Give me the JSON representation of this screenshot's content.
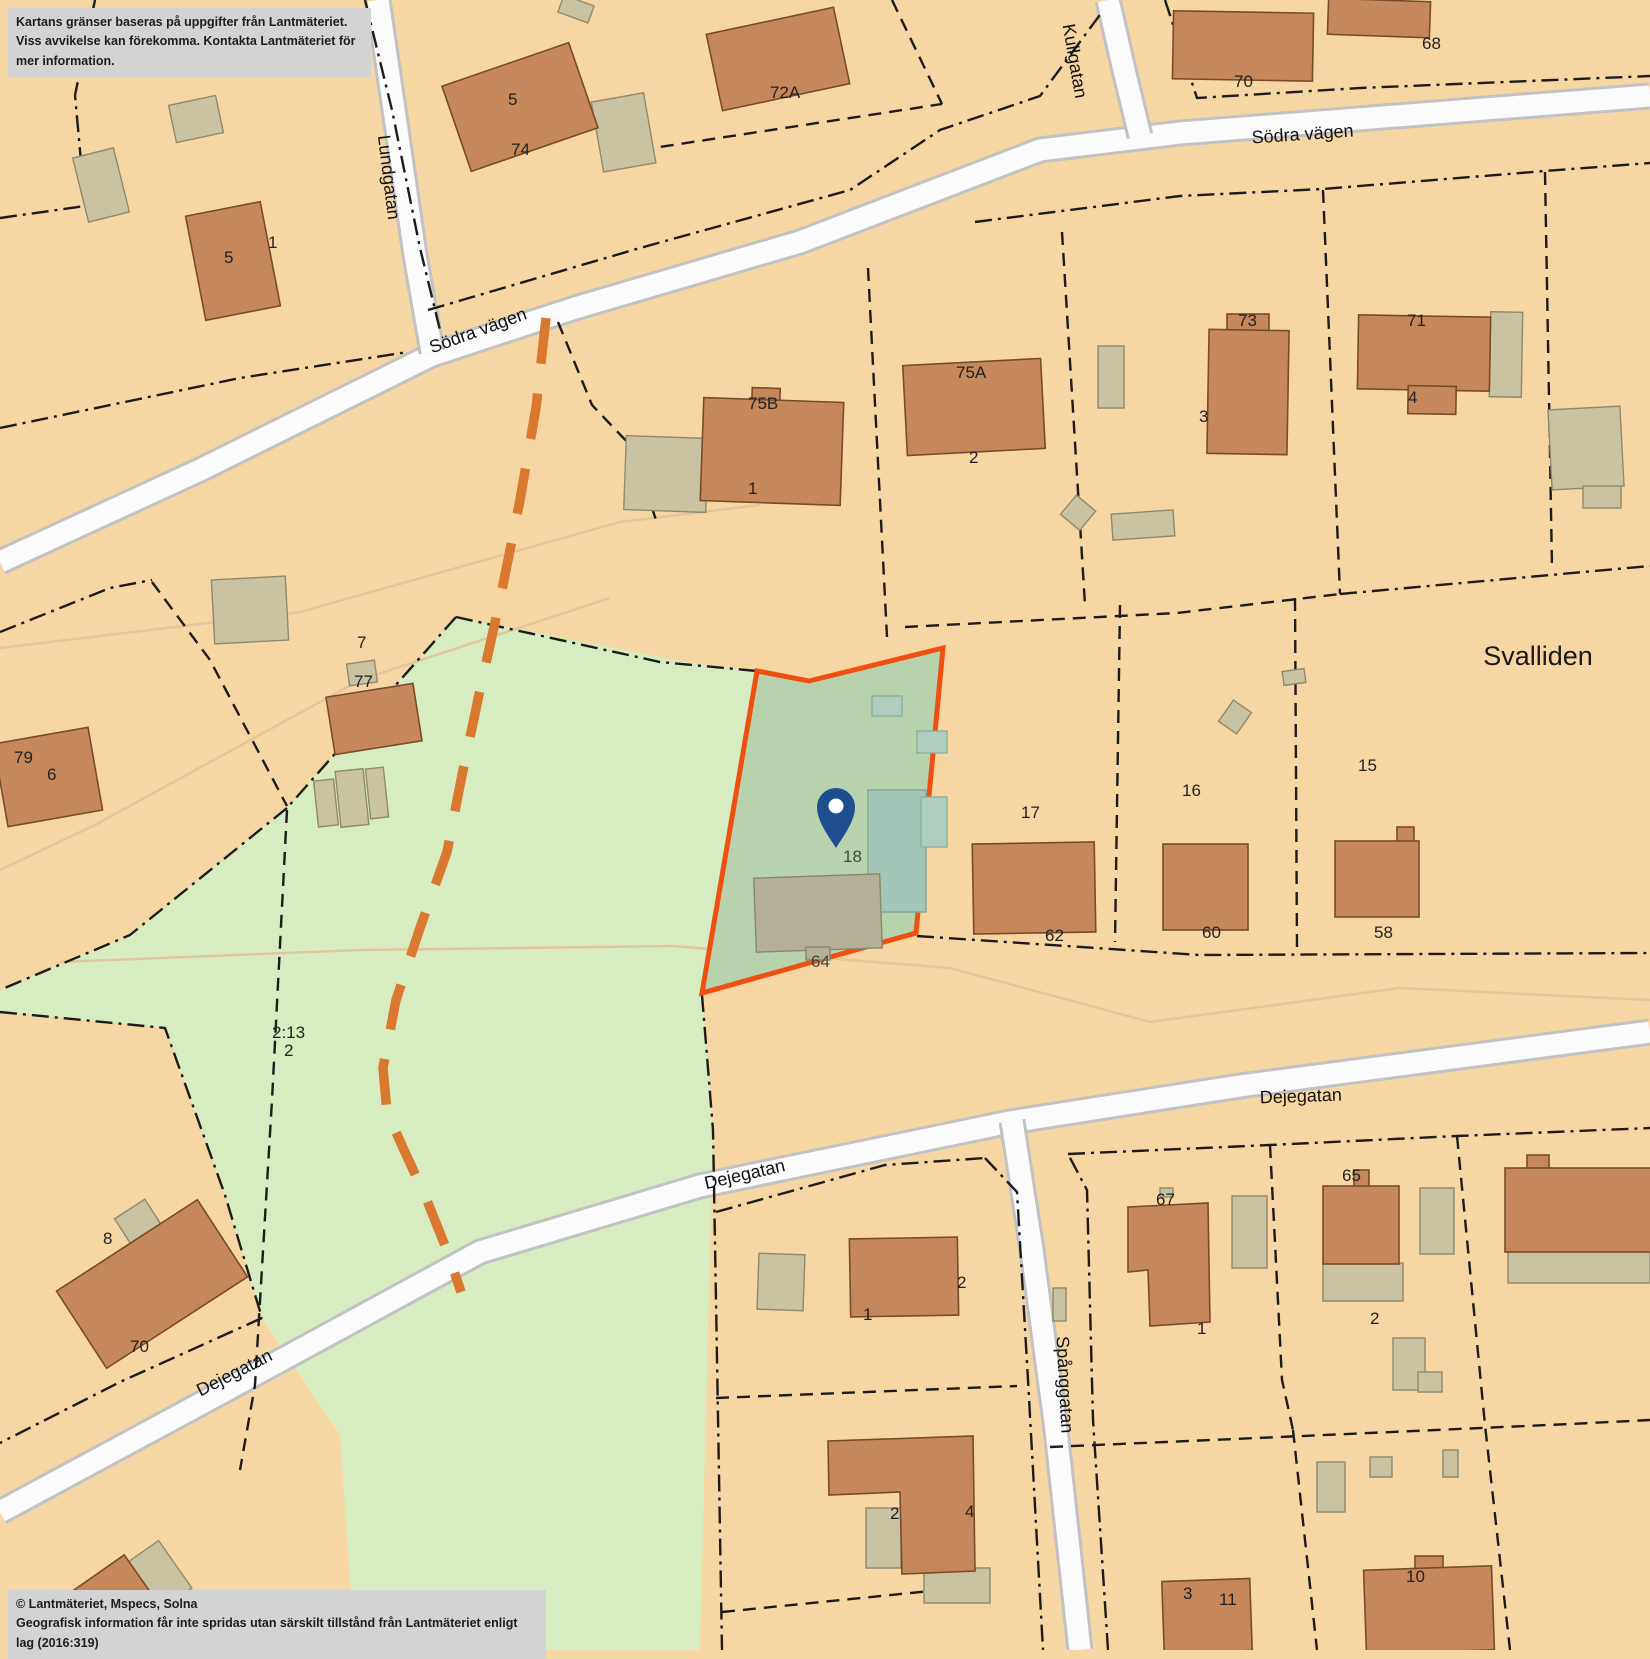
{
  "notices": {
    "disclaimer_line1": "Kartans gränser baseras på uppgifter från Lantmäteriet.",
    "disclaimer_line2": "Viss avvikelse kan förekomma. Kontakta Lantmäteriet för mer information.",
    "copyright_line1": "© Lantmäteriet, Mspecs, Solna",
    "copyright_line2": "Geografisk information får inte spridas utan särskilt tillstånd från Lantmäteriet enligt lag (2016:319)"
  },
  "streets": {
    "lundgatan": "Lundgatan",
    "kullgatan": "Kullgatan",
    "sodra_vagen": "Södra vägen",
    "dejegatan": "Dejegatan",
    "spanggatan": "Spånggatan"
  },
  "area": {
    "name": "Svalliden"
  },
  "marker": {
    "label": "18",
    "icon": "location-pin-icon",
    "color": "#1d4e8f"
  },
  "highlight": {
    "house_label": "64",
    "border_color": "#f04f12",
    "fill_color": "#b7d2ac"
  },
  "labels": [
    {
      "t": "5"
    },
    {
      "t": "1"
    },
    {
      "t": "5"
    },
    {
      "t": "74"
    },
    {
      "t": "72A"
    },
    {
      "t": "68"
    },
    {
      "t": "70"
    },
    {
      "t": "75B"
    },
    {
      "t": "1"
    },
    {
      "t": "75A"
    },
    {
      "t": "2"
    },
    {
      "t": "73"
    },
    {
      "t": "3"
    },
    {
      "t": "71"
    },
    {
      "t": "4"
    },
    {
      "t": "7"
    },
    {
      "t": "77"
    },
    {
      "t": "79"
    },
    {
      "t": "6"
    },
    {
      "t": "15"
    },
    {
      "t": "58"
    },
    {
      "t": "16"
    },
    {
      "t": "60"
    },
    {
      "t": "17"
    },
    {
      "t": "62"
    },
    {
      "t": "18"
    },
    {
      "t": "64"
    },
    {
      "t": "2:13"
    },
    {
      "t": "2"
    },
    {
      "t": "8"
    },
    {
      "t": "70"
    },
    {
      "t": "67"
    },
    {
      "t": "1"
    },
    {
      "t": "65"
    },
    {
      "t": "2"
    },
    {
      "t": "1"
    },
    {
      "t": "2"
    },
    {
      "t": "2"
    },
    {
      "t": "4"
    },
    {
      "t": "3"
    },
    {
      "t": "11"
    },
    {
      "t": "10"
    }
  ],
  "colors": {
    "parcel_base": "#f6d6a3",
    "green_area": "#d7ecc0",
    "highlight_fill": "#b7d2ac",
    "highlight_border": "#f04f12",
    "building_brown": "#c6875a",
    "building_gray": "#c9c3a3",
    "road_fill": "#fbfbfb",
    "trail_orange": "#d9782e",
    "pin_blue": "#1d4e8f",
    "notice_bg": "#d3d3d3"
  }
}
